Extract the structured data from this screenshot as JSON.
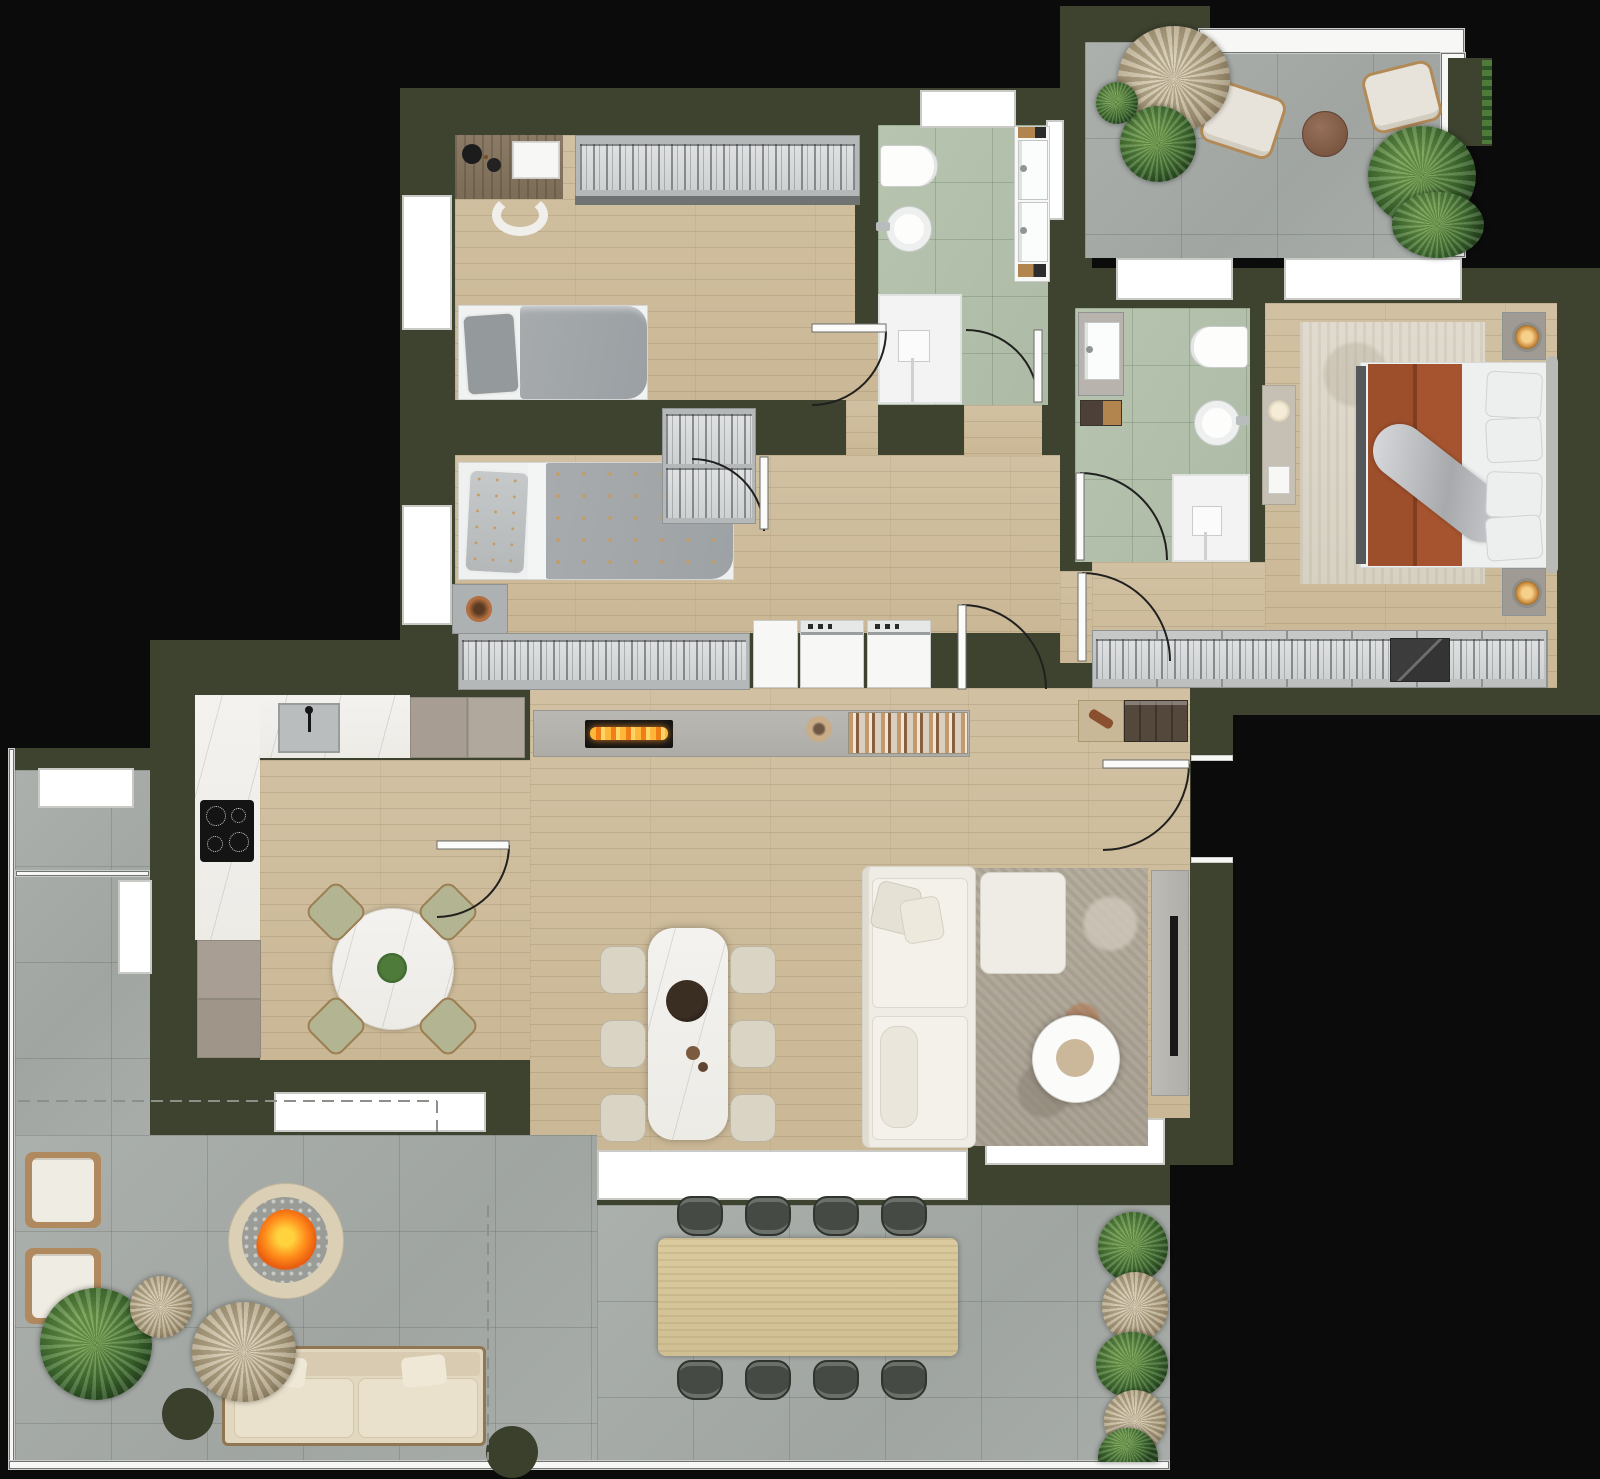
{
  "title": "Furnished apartment floor plan — top-down architectural render",
  "canvas": {
    "width": 1600,
    "height": 1479
  },
  "palette": {
    "background": "#0b0b0b",
    "walls": "#3e4330",
    "wood_floor": "#cfbfa0",
    "terrace_tile": "#a6aba7",
    "bathroom_tile": "#b4c1ac",
    "marble": "#f3f1ed",
    "wardrobe_grey": "#c6c9c8",
    "accent_rust": "#a5542f",
    "fire_orange": "#ff8a1a",
    "plant_green": "#4e7a3a",
    "pampas_tan": "#b9ad93",
    "sofa_white": "#efece5"
  },
  "rooms": [
    {
      "id": "bedroom-1",
      "label": "Bedroom 1",
      "floor": "wood",
      "furniture": [
        "desk with open book and turntable",
        "desk chair",
        "glass-front wardrobe",
        "single bed with grey bedding"
      ]
    },
    {
      "id": "bedroom-2",
      "label": "Bedroom 2",
      "floor": "wood",
      "furniture": [
        "single bed with star-pattern duvet",
        "nightstand with copper lamp",
        "chest wardrobe"
      ]
    },
    {
      "id": "bathroom-1",
      "label": "Main bathroom",
      "floor": "green tile",
      "fixtures": [
        "toilet",
        "bidet",
        "double-basin vanity",
        "walk-in shower"
      ]
    },
    {
      "id": "hallway",
      "label": "Hallway / laundry",
      "floor": "wood",
      "furniture": [
        "washer",
        "dryer",
        "counter"
      ]
    },
    {
      "id": "bathroom-2",
      "label": "En-suite bathroom",
      "floor": "green tile",
      "fixtures": [
        "vanity",
        "toilet",
        "bidet",
        "walk-in shower"
      ]
    },
    {
      "id": "master-bedroom",
      "label": "Master bedroom",
      "floor": "wood",
      "furniture": [
        "double bed with terracotta runner and silver throw",
        "2 nightstands with lamps",
        "area rug",
        "wall bench console",
        "full-width wardrobe"
      ]
    },
    {
      "id": "kitchen",
      "label": "Kitchen / breakfast room",
      "floor": "wood",
      "furniture": [
        "L-shaped marble counter",
        "sink",
        "induction hob",
        "tall units",
        "round marble table",
        "4 chairs"
      ]
    },
    {
      "id": "living-room",
      "label": "Living / dining room",
      "floor": "wood",
      "furniture": [
        "media wall with linear fireplace and books",
        "marble dining table",
        "6 chairs",
        "L-shaped sofa with ottoman",
        "round coffee table",
        "area rug",
        "TV unit",
        "entry console"
      ]
    },
    {
      "id": "terrace-upper",
      "label": "Upper terrace",
      "floor": "grey tile",
      "furniture": [
        "2 lounge chairs",
        "round side table",
        "potted plants",
        "railing planter"
      ]
    },
    {
      "id": "terrace-left",
      "label": "Side terrace strip",
      "floor": "grey tile",
      "furniture": []
    },
    {
      "id": "terrace-lower",
      "label": "Lower terrace",
      "floor": "grey tile",
      "furniture": [
        "fire pit",
        "2 armchairs",
        "outdoor sofa",
        "outdoor dining table",
        "8 outdoor chairs",
        "2 round planters",
        "grasses"
      ]
    }
  ],
  "doors": {
    "count": 8,
    "style": "quarter-circle swing arcs"
  },
  "windows": {
    "count": 12,
    "style": "white sill bands with mullion lines"
  },
  "annotations": {
    "boundary_lines": "grey dashed terrace limits"
  }
}
